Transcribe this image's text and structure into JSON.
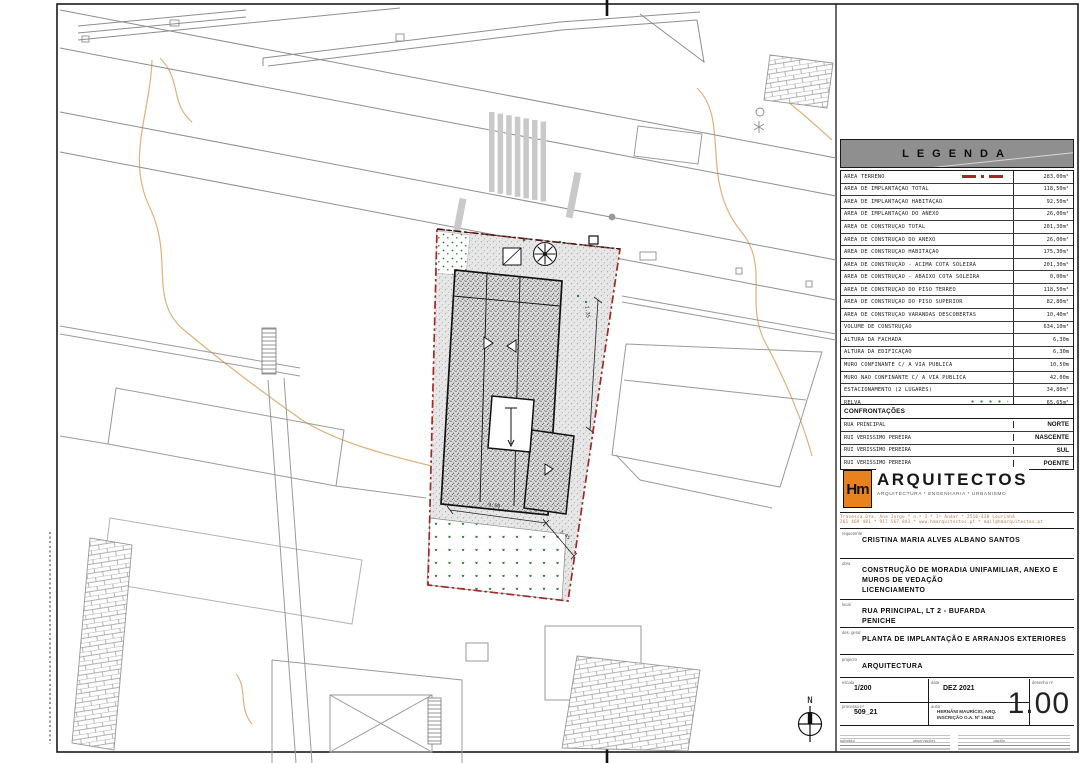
{
  "legend": {
    "title": "LEGENDA",
    "rows": [
      {
        "label": "ÁREA TERRENO",
        "value": "283,00m²",
        "symbol": "red-dashdot-line"
      },
      {
        "label": "ÁREA DE IMPLANTAÇÃO TOTAL",
        "value": "118,50m²"
      },
      {
        "label": "ÁREA DE IMPLANTAÇÃO HABITAÇÃO",
        "value": "92,50m²"
      },
      {
        "label": "ÁREA DE IMPLANTAÇÃO DO ANEXO",
        "value": "26,00m²"
      },
      {
        "label": "ÁREA DE CONSTRUÇÃO TOTAL",
        "value": "201,30m²"
      },
      {
        "label": "ÁREA DE CONSTRUÇÃO DO ANEXO",
        "value": "26,00m²"
      },
      {
        "label": "ÁREA DE CONSTRUÇÃO HABITAÇÃO",
        "value": "175,30m²"
      },
      {
        "label": "ÁREA DE CONSTRUÇÃO - ACIMA COTA SOLEIRA",
        "value": "201,30m²"
      },
      {
        "label": "ÁREA DE CONSTRUÇÃO - ABAIXO COTA SOLEIRA",
        "value": "0,00m²"
      },
      {
        "label": "ÁREA DE CONSTRUÇÃO DO PISO TÉRREO",
        "value": "118,50m²"
      },
      {
        "label": "ÁREA DE CONSTRUÇÃO DO PISO SUPERIOR",
        "value": "82,80m²"
      },
      {
        "label": "ÁREA DE CONSTRUÇÃO VARANDAS DESCOBERTAS",
        "value": "10,40m²"
      },
      {
        "label": "VOLUME DE CONSTRUÇÃO",
        "value": "634,10m³"
      },
      {
        "label": "ALTURA DA FACHADA",
        "value": "6,30m"
      },
      {
        "label": "ALTURA DA EDIFICAÇÃO",
        "value": "6,30m"
      },
      {
        "label": "MURO CONFINANTE C/ A VIA PÚBLICA",
        "value": "10,50m"
      },
      {
        "label": "MURO NÃO CONFINANTE C/ A VIA PÚBLICA",
        "value": "42,00m"
      },
      {
        "label": "ESTACIONAMENTO (2 LUGARES)",
        "value": "34,80m²"
      },
      {
        "label": "RELVA",
        "value": "65,65m²",
        "symbol": "grass-swatch"
      },
      {
        "label": "PAVÊ",
        "value": "96,60m²",
        "symbol": "pave-swatch"
      }
    ]
  },
  "confrontacoes": {
    "title": "CONFRONTAÇÕES",
    "rows": [
      {
        "label": "RUA PRINCIPAL",
        "value": "NORTE"
      },
      {
        "label": "RUI VERISSIMO PEREIRA",
        "value": "NASCENTE"
      },
      {
        "label": "RUI VERISSIMO PEREIRA",
        "value": "SUL"
      },
      {
        "label": "RUI VERISSIMO PEREIRA",
        "value": "POENTE"
      }
    ]
  },
  "firm": {
    "logo": "Hm",
    "name": "ARQUITECTOS",
    "tagline": "ARQUITECTURA * ENGENHARIA * URBANISMO",
    "address_line1": "Travessa Dra. Ana Jorge * n.º 3 * 1º Andar * 2510-438 Lourinhã",
    "address_line2": "261 469 481 * 917 567 843 * www.hmarquitectos.pt * mail@hmarquitectos.pt"
  },
  "fields": {
    "requerente_label": "requerente",
    "requerente": "CRISTINA MARIA ALVES ALBANO SANTOS",
    "obra_label": "obra",
    "obra_line1": "CONSTRUÇÃO DE MORADIA UNIFAMILIAR, ANEXO E",
    "obra_line2": "MUROS DE VEDAÇÃO",
    "obra_line3": "LICENCIAMENTO",
    "local_label": "local",
    "local_line1": "RUA PRINCIPAL, LT 2 - BUFARDA",
    "local_line2": "PENICHE",
    "desgeral_label": "des. geral",
    "desgeral": "PLANTA DE IMPLANTAÇÃO E ARRANJOS EXTERIORES",
    "projecto_label": "projecto",
    "projecto": "ARQUITECTURA",
    "escala_label": "escala",
    "escala": "1/200",
    "data_label": "data",
    "data": "DEZ 2021",
    "desenho_label": "desenho nº",
    "desenho": "1.00",
    "processo_label": "processo nº",
    "processo": "509_21",
    "autor_label": "autor",
    "autor_line1": "HERNÂNI MAURÍCIO, ARQ.",
    "autor_line2": "INSCRIÇÃO O.A. Nº 19462",
    "substitui_label": "substitui",
    "observacoes_label": "observações",
    "dactilo_label": "dactilo"
  },
  "plan": {
    "north_label": "N",
    "dim1": "9.50",
    "dim2": "3.45",
    "dim3": "1.35"
  },
  "colors": {
    "boundary_red": "#9e2b25",
    "contour_orange": "#e2b07a",
    "grass_green": "#2f7a33",
    "logo_orange": "#e8821e",
    "neighbor_gray": "#8e8e8e"
  }
}
